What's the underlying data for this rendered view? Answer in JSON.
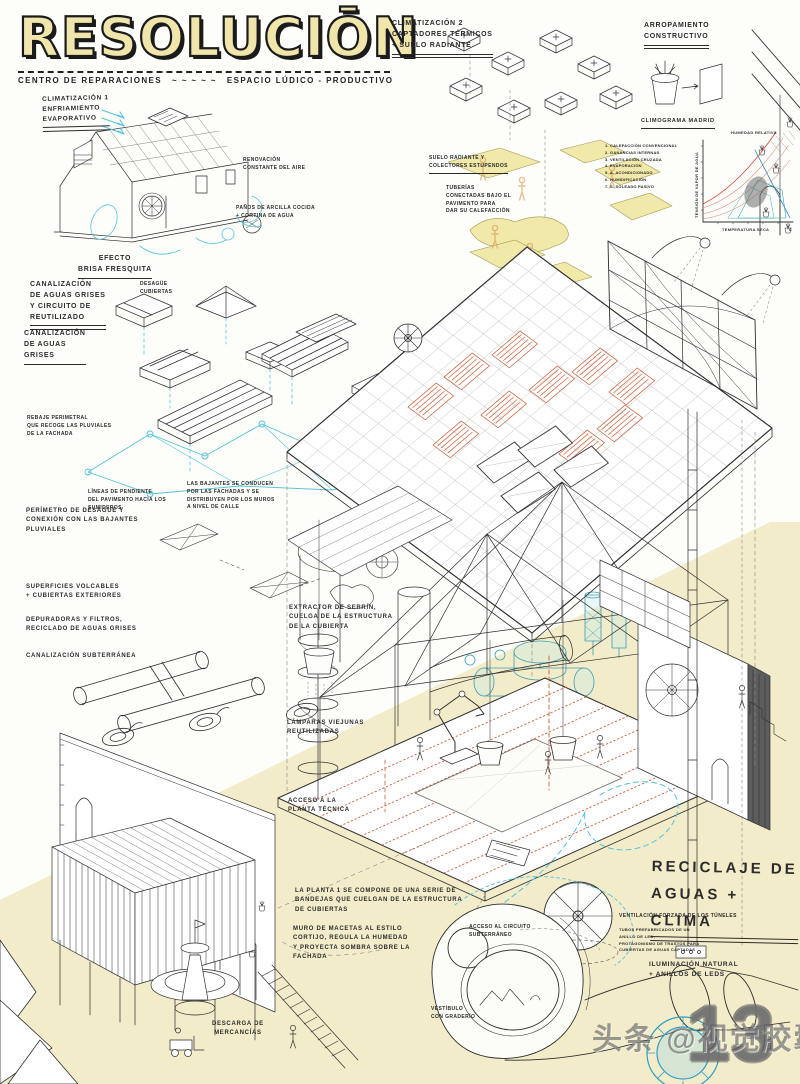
{
  "poster": {
    "title": "RESOLUCIŌN",
    "subtitle_left": "CENTRO DE REPARACIONES",
    "subtitle_tildes": "~ ~ ~ ~ ~",
    "subtitle_right": "ESPACIO LÚDICO - PRODUCTIVO"
  },
  "labels": {
    "clim1": "CLIMATIZACIÓN 1\nENFRIAMIENTO\nEVAPORATIVO",
    "renovacion": "RENOVACIÓN\nCONSTANTE DEL AIRE",
    "panos": "PAÑOS DE ARCILLA COCIDA\n+ CORTINA DE AGUA",
    "efecto": "EFECTO\nBRISA FRESQUITA",
    "canalizacion_circuito": "CANALIZACIÓN\nDE AGUAS GRISES\nY CIRCUITO DE\nREUTILIZADO",
    "desague_cubiertas": "DESAGÜE\nCUBIERTAS",
    "canalizacion_grises": "CANALIZACIÓN\nDE AGUAS\nGRISES",
    "rebaje": "REBAJE PERIMETRAL\nQUE RECOGE LAS PLUVIALES\nDE LA FACHADA",
    "lineas_pendiente": "LÍNEAS DE PENDIENTE\nDEL PAVIMENTO HACIA LOS\nSUMIDEROS",
    "bajantes": "LAS BAJANTES SE CONDUCEN\nPOR LAS FACHADAS Y SE\nDISTRIBUYEN POR LOS MUROS\nA NIVEL DE CALLE",
    "perimetro": "PERÍMETRO DE DESAGÜE Y\nCONEXIÓN CON LAS BAJANTES\nPLUVIALES",
    "superficies": "SUPERFICIES VOLCABLES\n+ CUBIERTAS EXTERIORES",
    "depuradoras": "DEPURADORAS Y FILTROS,\nRECICLADO DE AGUAS GRISES",
    "canalizacion_sub": "CANALIZACIÓN SUBTERRÁNEA",
    "extractor": "EXTRACTOR DE SERRÍN,\nCUELGA DE LA ESTRUCTURA\nDE LA CUBIERTA",
    "lamparas": "LÁMPARAS VIEJUNAS\nREUTILIZADAS",
    "acceso_planta": "ACCESO A LA\nPLANTA TÉCNICA",
    "planta1": "LA PLANTA 1 SE COMPONE DE UNA SERIE DE\nBANDEJAS QUE CUELGAN DE LA ESTRUCTURA\nDE CUBIERTAS",
    "muro_macetas": "MURO DE MACETAS AL ESTILO\nCORTIJO, REGULA LA HUMEDAD\nY PROYECTA SOMBRA SOBRE LA\nFACHADA",
    "descarga": "DESCARGA DE\nMERCANCÍAS",
    "clim2": "CLIMATIZACIÓN 2\nCAPTADORES TÉRMICOS\n+ SUELO RADIANTE",
    "arropamiento": "ARROPAMIENTO\nCONSTRUCTIVO",
    "suelo_radiante": "SUELO RADIANTE Y\nCOLECTORES ESTUPENDOS",
    "tuberias": "TUBERÍAS\nCONECTADAS BAJO EL\nPAVIMENTO PARA\nDAR SU CALEFACCIÓN",
    "reciclaje": "RECICLAJE DE\nAGUAS + CLIMA",
    "ventilacion": "VENTILACIÓN FORZADA DE LOS TÚNELES",
    "tubos": "TUBOS PREFABRICADOS DE UN\nANILLO DE LED,\nPROTAGONISMO DE TRASTOS PARA\nCUBIERTAS DE AGUAS CAPTADAS",
    "iluminacion": "ILUMINACIÓN NATURAL\n+ ANILLOS DE LEDS",
    "acceso_circuito": "ACCESO AL CIRCUITO\nSUBTERRÁNEO",
    "vestibulo": "VESTÍBULO\nCON GRADERÍO"
  },
  "chart": {
    "type": "area",
    "title": "CLIMOGRAMA MADRID",
    "x_axis": "TEMPERATURA SECA",
    "x_unit": "°C",
    "y_axis": "TENSIÓN DE VAPOR DE AGUA",
    "top_label": "HUMEDAD RELATIVA",
    "legend_text": "1. CALEFACCIÓN CONVENCIONAL\n2. GANANCIAS INTERNAS\n3. VENTILACIÓN CRUZADA\n4. EVAPORACIÓN\n5. A. ACONDICIONADO\n6. HUMIDIFICACIÓN\n7. S. SOLEADO PASIVO"
  },
  "watermark": {
    "text": "头条 @视觉胶囊",
    "number": "13"
  },
  "colors": {
    "paper_yellow": "#f2ecca",
    "plate_yellow": "#f1e9a9",
    "accent_cyan": "#54c3da",
    "accent_orange": "#c9603a",
    "ink": "#2e2e2e",
    "title_fill": "#f0e5ab"
  }
}
